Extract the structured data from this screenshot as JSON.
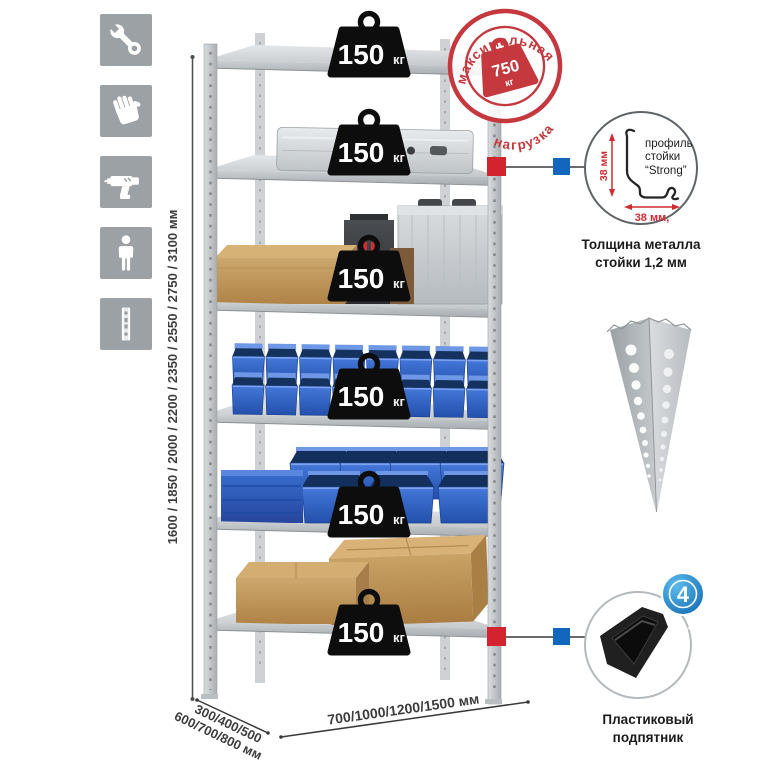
{
  "icons": {
    "items": [
      {
        "name": "wrench"
      },
      {
        "name": "gloves"
      },
      {
        "name": "drill"
      },
      {
        "name": "person"
      },
      {
        "name": "post-profile"
      }
    ]
  },
  "height_dim": {
    "label": "1600 / 1850 / 2000 / 2200 / 2350 / 2550 / 2750 / 3100 мм"
  },
  "load_badge": {
    "value": "150",
    "unit": "кг"
  },
  "max_load_stamp": {
    "arc_top": "максимальная",
    "arc_bottom": "нагрузка",
    "value": "750",
    "unit": "кг"
  },
  "profile_callout": {
    "dim_vertical": "38 мм",
    "dim_horizontal": "38 мм,",
    "label_line1": "профиль",
    "label_line2": "стойки",
    "label_line3": "“Strong”",
    "caption_line1": "Толщина металла",
    "caption_line2": "стойки 1,2 мм"
  },
  "foot_callout": {
    "badge_value": "4",
    "badge_arc": "в комплекте",
    "caption_line1": "Пластиковый",
    "caption_line2": "подпятник"
  },
  "depth_dim": {
    "line1": "300/400/500",
    "line2": "600/700/800 мм"
  },
  "width_dim": {
    "label": "700/1000/1200/1500 мм"
  },
  "colors": {
    "stamp_red": "#c5383e",
    "marker_red": "#d2232e",
    "marker_blue": "#1266bb",
    "bin_blue": "#2f63c4",
    "metal": "#c7cbce"
  }
}
